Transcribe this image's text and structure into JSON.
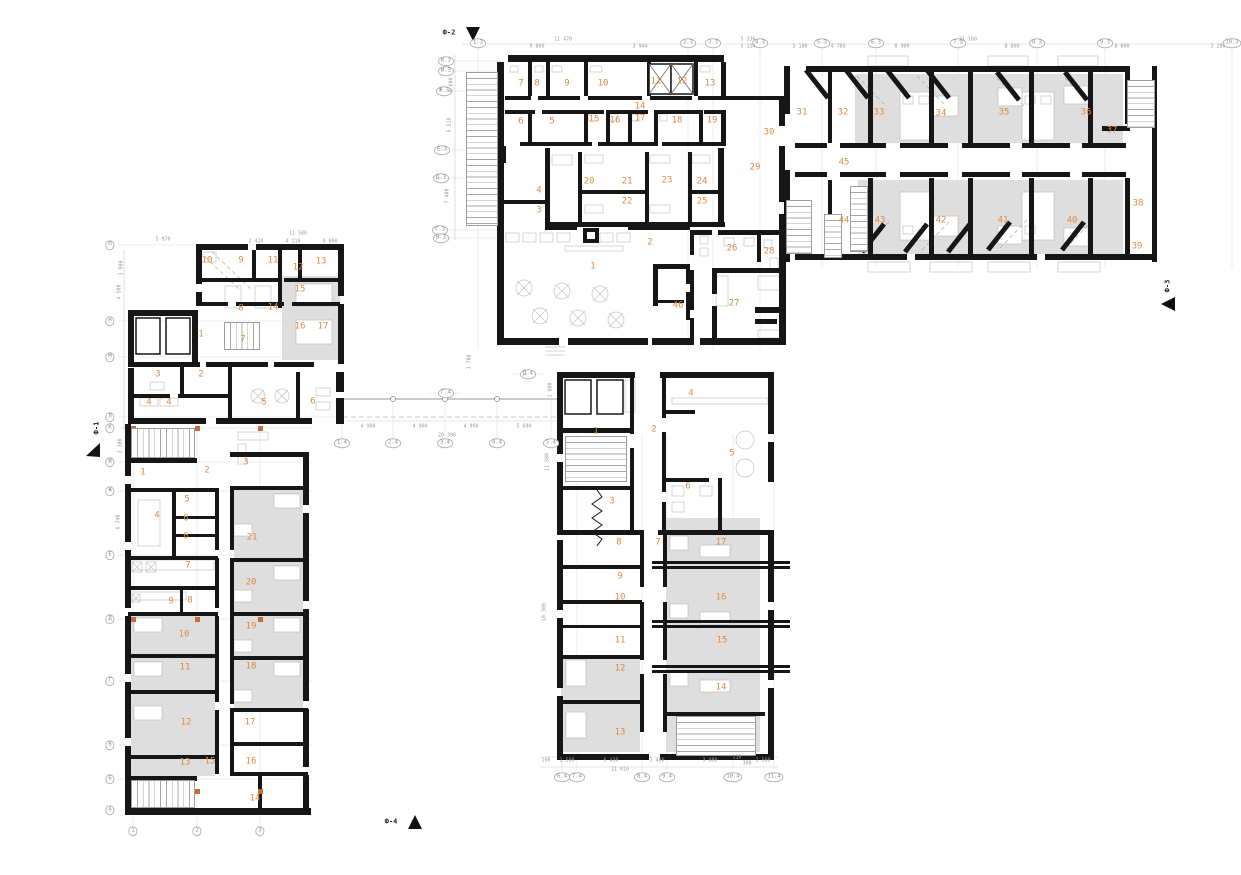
{
  "drawing": {
    "type": "architectural floor plan",
    "colors": {
      "accent": "#DD8B42",
      "wall": "#161616",
      "room_fill": "#DEDEDE",
      "column_marker": "#C1703C",
      "dim_text": "#9A9A9A"
    },
    "section_markers": [
      {
        "label": "Ф-2",
        "x": 449,
        "y": 33
      },
      {
        "label": "Ф-3",
        "x": 1168,
        "y": 286,
        "rot": -90
      },
      {
        "label": "Ф-4",
        "x": 391,
        "y": 822
      },
      {
        "label": "Ф-1",
        "x": 97,
        "y": 428,
        "rot": -90
      }
    ],
    "wings": {
      "top_center": {
        "rooms": [
          {
            "n": "7",
            "x": 521,
            "y": 84
          },
          {
            "n": "8",
            "x": 537,
            "y": 84
          },
          {
            "n": "9",
            "x": 567,
            "y": 84
          },
          {
            "n": "10",
            "x": 603,
            "y": 84
          },
          {
            "n": "11",
            "x": 656,
            "y": 82
          },
          {
            "n": "12",
            "x": 682,
            "y": 82
          },
          {
            "n": "13",
            "x": 710,
            "y": 84
          },
          {
            "n": "14",
            "x": 640,
            "y": 107
          },
          {
            "n": "6",
            "x": 521,
            "y": 122
          },
          {
            "n": "5",
            "x": 552,
            "y": 122
          },
          {
            "n": "15",
            "x": 594,
            "y": 120
          },
          {
            "n": "16",
            "x": 615,
            "y": 121
          },
          {
            "n": "17",
            "x": 640,
            "y": 119
          },
          {
            "n": "18",
            "x": 677,
            "y": 121
          },
          {
            "n": "19",
            "x": 712,
            "y": 121
          },
          {
            "n": "4",
            "x": 539,
            "y": 191
          },
          {
            "n": "3",
            "x": 539,
            "y": 211
          },
          {
            "n": "20",
            "x": 589,
            "y": 182
          },
          {
            "n": "21",
            "x": 627,
            "y": 182
          },
          {
            "n": "22",
            "x": 627,
            "y": 202
          },
          {
            "n": "23",
            "x": 667,
            "y": 181
          },
          {
            "n": "24",
            "x": 702,
            "y": 182
          },
          {
            "n": "25",
            "x": 702,
            "y": 202
          },
          {
            "n": "1",
            "x": 593,
            "y": 267
          },
          {
            "n": "2",
            "x": 650,
            "y": 243
          },
          {
            "n": "26",
            "x": 732,
            "y": 249
          },
          {
            "n": "27",
            "x": 734,
            "y": 304
          },
          {
            "n": "28",
            "x": 769,
            "y": 252
          },
          {
            "n": "29",
            "x": 755,
            "y": 168
          },
          {
            "n": "30",
            "x": 769,
            "y": 133
          },
          {
            "n": "46",
            "x": 678,
            "y": 306
          }
        ]
      },
      "right": {
        "rooms": [
          {
            "n": "31",
            "x": 802,
            "y": 113
          },
          {
            "n": "32",
            "x": 843,
            "y": 113
          },
          {
            "n": "33",
            "x": 879,
            "y": 113
          },
          {
            "n": "34",
            "x": 941,
            "y": 114
          },
          {
            "n": "35",
            "x": 1004,
            "y": 113
          },
          {
            "n": "36",
            "x": 1086,
            "y": 113
          },
          {
            "n": "37",
            "x": 1112,
            "y": 131
          },
          {
            "n": "45",
            "x": 844,
            "y": 163
          },
          {
            "n": "44",
            "x": 844,
            "y": 221
          },
          {
            "n": "43",
            "x": 880,
            "y": 221
          },
          {
            "n": "42",
            "x": 941,
            "y": 221
          },
          {
            "n": "41",
            "x": 1003,
            "y": 221
          },
          {
            "n": "40",
            "x": 1072,
            "y": 221
          },
          {
            "n": "38",
            "x": 1138,
            "y": 204
          },
          {
            "n": "39",
            "x": 1137,
            "y": 247
          }
        ]
      },
      "upper_left": {
        "rooms": [
          {
            "n": "10",
            "x": 207,
            "y": 261
          },
          {
            "n": "9",
            "x": 241,
            "y": 261
          },
          {
            "n": "11",
            "x": 273,
            "y": 261
          },
          {
            "n": "12",
            "x": 298,
            "y": 268
          },
          {
            "n": "13",
            "x": 321,
            "y": 262
          },
          {
            "n": "15",
            "x": 300,
            "y": 290
          },
          {
            "n": "8",
            "x": 241,
            "y": 309
          },
          {
            "n": "14",
            "x": 273,
            "y": 308
          },
          {
            "n": "16",
            "x": 300,
            "y": 327
          },
          {
            "n": "17",
            "x": 323,
            "y": 327
          },
          {
            "n": "1",
            "x": 201,
            "y": 335
          },
          {
            "n": "7",
            "x": 243,
            "y": 340
          },
          {
            "n": "3",
            "x": 158,
            "y": 375
          },
          {
            "n": "2",
            "x": 201,
            "y": 375
          },
          {
            "n": "4",
            "x": 149,
            "y": 403
          },
          {
            "n": "4",
            "x": 169,
            "y": 403
          },
          {
            "n": "5",
            "x": 264,
            "y": 403
          },
          {
            "n": "6",
            "x": 313,
            "y": 402
          }
        ]
      },
      "lower_left": {
        "rooms": [
          {
            "n": "1",
            "x": 143,
            "y": 473
          },
          {
            "n": "2",
            "x": 207,
            "y": 471
          },
          {
            "n": "3",
            "x": 246,
            "y": 463
          },
          {
            "n": "5",
            "x": 187,
            "y": 500
          },
          {
            "n": "4",
            "x": 157,
            "y": 516
          },
          {
            "n": "6",
            "x": 186,
            "y": 519
          },
          {
            "n": "6",
            "x": 186,
            "y": 537
          },
          {
            "n": "21",
            "x": 252,
            "y": 538
          },
          {
            "n": "7",
            "x": 188,
            "y": 566
          },
          {
            "n": "20",
            "x": 251,
            "y": 583
          },
          {
            "n": "9",
            "x": 171,
            "y": 602
          },
          {
            "n": "8",
            "x": 190,
            "y": 601
          },
          {
            "n": "19",
            "x": 251,
            "y": 627
          },
          {
            "n": "10",
            "x": 184,
            "y": 635
          },
          {
            "n": "11",
            "x": 185,
            "y": 668
          },
          {
            "n": "18",
            "x": 251,
            "y": 667
          },
          {
            "n": "12",
            "x": 186,
            "y": 723
          },
          {
            "n": "17",
            "x": 250,
            "y": 723
          },
          {
            "n": "13",
            "x": 185,
            "y": 763
          },
          {
            "n": "15",
            "x": 210,
            "y": 762
          },
          {
            "n": "16",
            "x": 251,
            "y": 762
          },
          {
            "n": "14",
            "x": 255,
            "y": 799
          }
        ]
      },
      "bottom_center": {
        "rooms": [
          {
            "n": "1",
            "x": 596,
            "y": 432
          },
          {
            "n": "2",
            "x": 654,
            "y": 430
          },
          {
            "n": "4",
            "x": 691,
            "y": 394
          },
          {
            "n": "5",
            "x": 732,
            "y": 454
          },
          {
            "n": "3",
            "x": 612,
            "y": 502
          },
          {
            "n": "6",
            "x": 688,
            "y": 487
          },
          {
            "n": "8",
            "x": 619,
            "y": 543
          },
          {
            "n": "7",
            "x": 658,
            "y": 543
          },
          {
            "n": "17",
            "x": 721,
            "y": 543
          },
          {
            "n": "9",
            "x": 620,
            "y": 577
          },
          {
            "n": "10",
            "x": 620,
            "y": 598
          },
          {
            "n": "16",
            "x": 721,
            "y": 598
          },
          {
            "n": "11",
            "x": 620,
            "y": 641
          },
          {
            "n": "15",
            "x": 722,
            "y": 641
          },
          {
            "n": "12",
            "x": 620,
            "y": 669
          },
          {
            "n": "14",
            "x": 721,
            "y": 688
          },
          {
            "n": "13",
            "x": 620,
            "y": 733
          }
        ]
      }
    },
    "grid_labels": [
      {
        "t": "1.3",
        "x": 478,
        "y": 43
      },
      {
        "t": "2.3",
        "x": 688,
        "y": 43
      },
      {
        "t": "3.3",
        "x": 713,
        "y": 43
      },
      {
        "t": "4.3",
        "x": 760,
        "y": 43
      },
      {
        "t": "5.3",
        "x": 822,
        "y": 43
      },
      {
        "t": "6.3",
        "x": 876,
        "y": 43
      },
      {
        "t": "7.3",
        "x": 958,
        "y": 43
      },
      {
        "t": "8.3",
        "x": 1037,
        "y": 43
      },
      {
        "t": "9.3",
        "x": 1105,
        "y": 43
      },
      {
        "t": "10.3",
        "x": 1232,
        "y": 43
      },
      {
        "t": "К.3",
        "x": 446,
        "y": 61
      },
      {
        "t": "И.3",
        "x": 446,
        "y": 71
      },
      {
        "t": "Ж.3",
        "x": 444,
        "y": 91
      },
      {
        "t": "Е.3",
        "x": 442,
        "y": 150
      },
      {
        "t": "Д.3",
        "x": 441,
        "y": 178
      },
      {
        "t": "Г.3",
        "x": 440,
        "y": 230
      },
      {
        "t": "В.3",
        "x": 441,
        "y": 238
      },
      {
        "t": "П",
        "x": 110,
        "y": 245
      },
      {
        "t": "Н",
        "x": 110,
        "y": 321
      },
      {
        "t": "М",
        "x": 110,
        "y": 357
      },
      {
        "t": "Л",
        "x": 110,
        "y": 417
      },
      {
        "t": "К",
        "x": 110,
        "y": 428
      },
      {
        "t": "И",
        "x": 110,
        "y": 462
      },
      {
        "t": "Ж",
        "x": 110,
        "y": 491
      },
      {
        "t": "Е",
        "x": 110,
        "y": 555
      },
      {
        "t": "Д",
        "x": 110,
        "y": 619
      },
      {
        "t": "Г",
        "x": 110,
        "y": 681
      },
      {
        "t": "В",
        "x": 110,
        "y": 745
      },
      {
        "t": "Б",
        "x": 110,
        "y": 779
      },
      {
        "t": "А",
        "x": 110,
        "y": 810
      },
      {
        "t": "1",
        "x": 133,
        "y": 831
      },
      {
        "t": "2",
        "x": 197,
        "y": 831
      },
      {
        "t": "3",
        "x": 260,
        "y": 831
      },
      {
        "t": "Г.4",
        "x": 446,
        "y": 393
      },
      {
        "t": "Д.4",
        "x": 528,
        "y": 374
      },
      {
        "t": "1.4",
        "x": 342,
        "y": 443
      },
      {
        "t": "2.4",
        "x": 393,
        "y": 443
      },
      {
        "t": "3.4",
        "x": 445,
        "y": 443
      },
      {
        "t": "4.4",
        "x": 497,
        "y": 443
      },
      {
        "t": "5.4",
        "x": 551,
        "y": 443
      },
      {
        "t": "6.4",
        "x": 562,
        "y": 777
      },
      {
        "t": "7.4",
        "x": 577,
        "y": 777
      },
      {
        "t": "8.4",
        "x": 642,
        "y": 777
      },
      {
        "t": "9.4",
        "x": 667,
        "y": 777
      },
      {
        "t": "10.4",
        "x": 733,
        "y": 777
      },
      {
        "t": "11.4",
        "x": 774,
        "y": 777
      }
    ],
    "dimensions": [
      {
        "t": "9 860",
        "x": 537,
        "y": 47
      },
      {
        "t": "11 470",
        "x": 563,
        "y": 40
      },
      {
        "t": "3 944",
        "x": 640,
        "y": 47
      },
      {
        "t": "5 336",
        "x": 748,
        "y": 40
      },
      {
        "t": "5 114",
        "x": 748,
        "y": 47
      },
      {
        "t": "3 180",
        "x": 800,
        "y": 47
      },
      {
        "t": "4 760",
        "x": 838,
        "y": 47
      },
      {
        "t": "8 900",
        "x": 902,
        "y": 47
      },
      {
        "t": "31 160",
        "x": 968,
        "y": 40
      },
      {
        "t": "8 800",
        "x": 1012,
        "y": 47
      },
      {
        "t": "8 600",
        "x": 1122,
        "y": 47
      },
      {
        "t": "3 286",
        "x": 1218,
        "y": 47
      },
      {
        "t": "5 970",
        "x": 163,
        "y": 240
      },
      {
        "t": "11 580",
        "x": 298,
        "y": 234
      },
      {
        "t": "2 420",
        "x": 256,
        "y": 242
      },
      {
        "t": "4 110",
        "x": 293,
        "y": 242
      },
      {
        "t": "9 000",
        "x": 330,
        "y": 242
      },
      {
        "t": "4 900",
        "x": 368,
        "y": 427
      },
      {
        "t": "4 900",
        "x": 420,
        "y": 427
      },
      {
        "t": "4 900",
        "x": 471,
        "y": 427
      },
      {
        "t": "5 690",
        "x": 524,
        "y": 427
      },
      {
        "t": "20 390",
        "x": 447,
        "y": 436
      },
      {
        "t": "100",
        "x": 546,
        "y": 761
      },
      {
        "t": "1 500",
        "x": 567,
        "y": 761
      },
      {
        "t": "6 430",
        "x": 611,
        "y": 761
      },
      {
        "t": "3 480",
        "x": 657,
        "y": 761
      },
      {
        "t": "3 080",
        "x": 710,
        "y": 761
      },
      {
        "t": "110",
        "x": 737,
        "y": 758
      },
      {
        "t": "300",
        "x": 747,
        "y": 764
      },
      {
        "t": "1 500",
        "x": 763,
        "y": 761
      },
      {
        "t": "21 010",
        "x": 620,
        "y": 770
      },
      {
        "t": "9 600",
        "x": 452,
        "y": 85,
        "rot": -90
      },
      {
        "t": "5 510",
        "x": 450,
        "y": 125,
        "rot": -90
      },
      {
        "t": "7 400",
        "x": 448,
        "y": 196,
        "rot": -90
      },
      {
        "t": "3 700",
        "x": 470,
        "y": 362,
        "rot": -90
      },
      {
        "t": "1 800",
        "x": 551,
        "y": 390,
        "rot": -90
      },
      {
        "t": "11 500",
        "x": 548,
        "y": 462,
        "rot": -90
      },
      {
        "t": "10 300",
        "x": 545,
        "y": 612,
        "rot": -90
      },
      {
        "t": "3 900",
        "x": 122,
        "y": 268,
        "rot": -90
      },
      {
        "t": "4 500",
        "x": 120,
        "y": 292,
        "rot": -90
      },
      {
        "t": "3 300",
        "x": 121,
        "y": 446,
        "rot": -90
      },
      {
        "t": "6 740",
        "x": 119,
        "y": 522,
        "rot": -90
      }
    ]
  }
}
